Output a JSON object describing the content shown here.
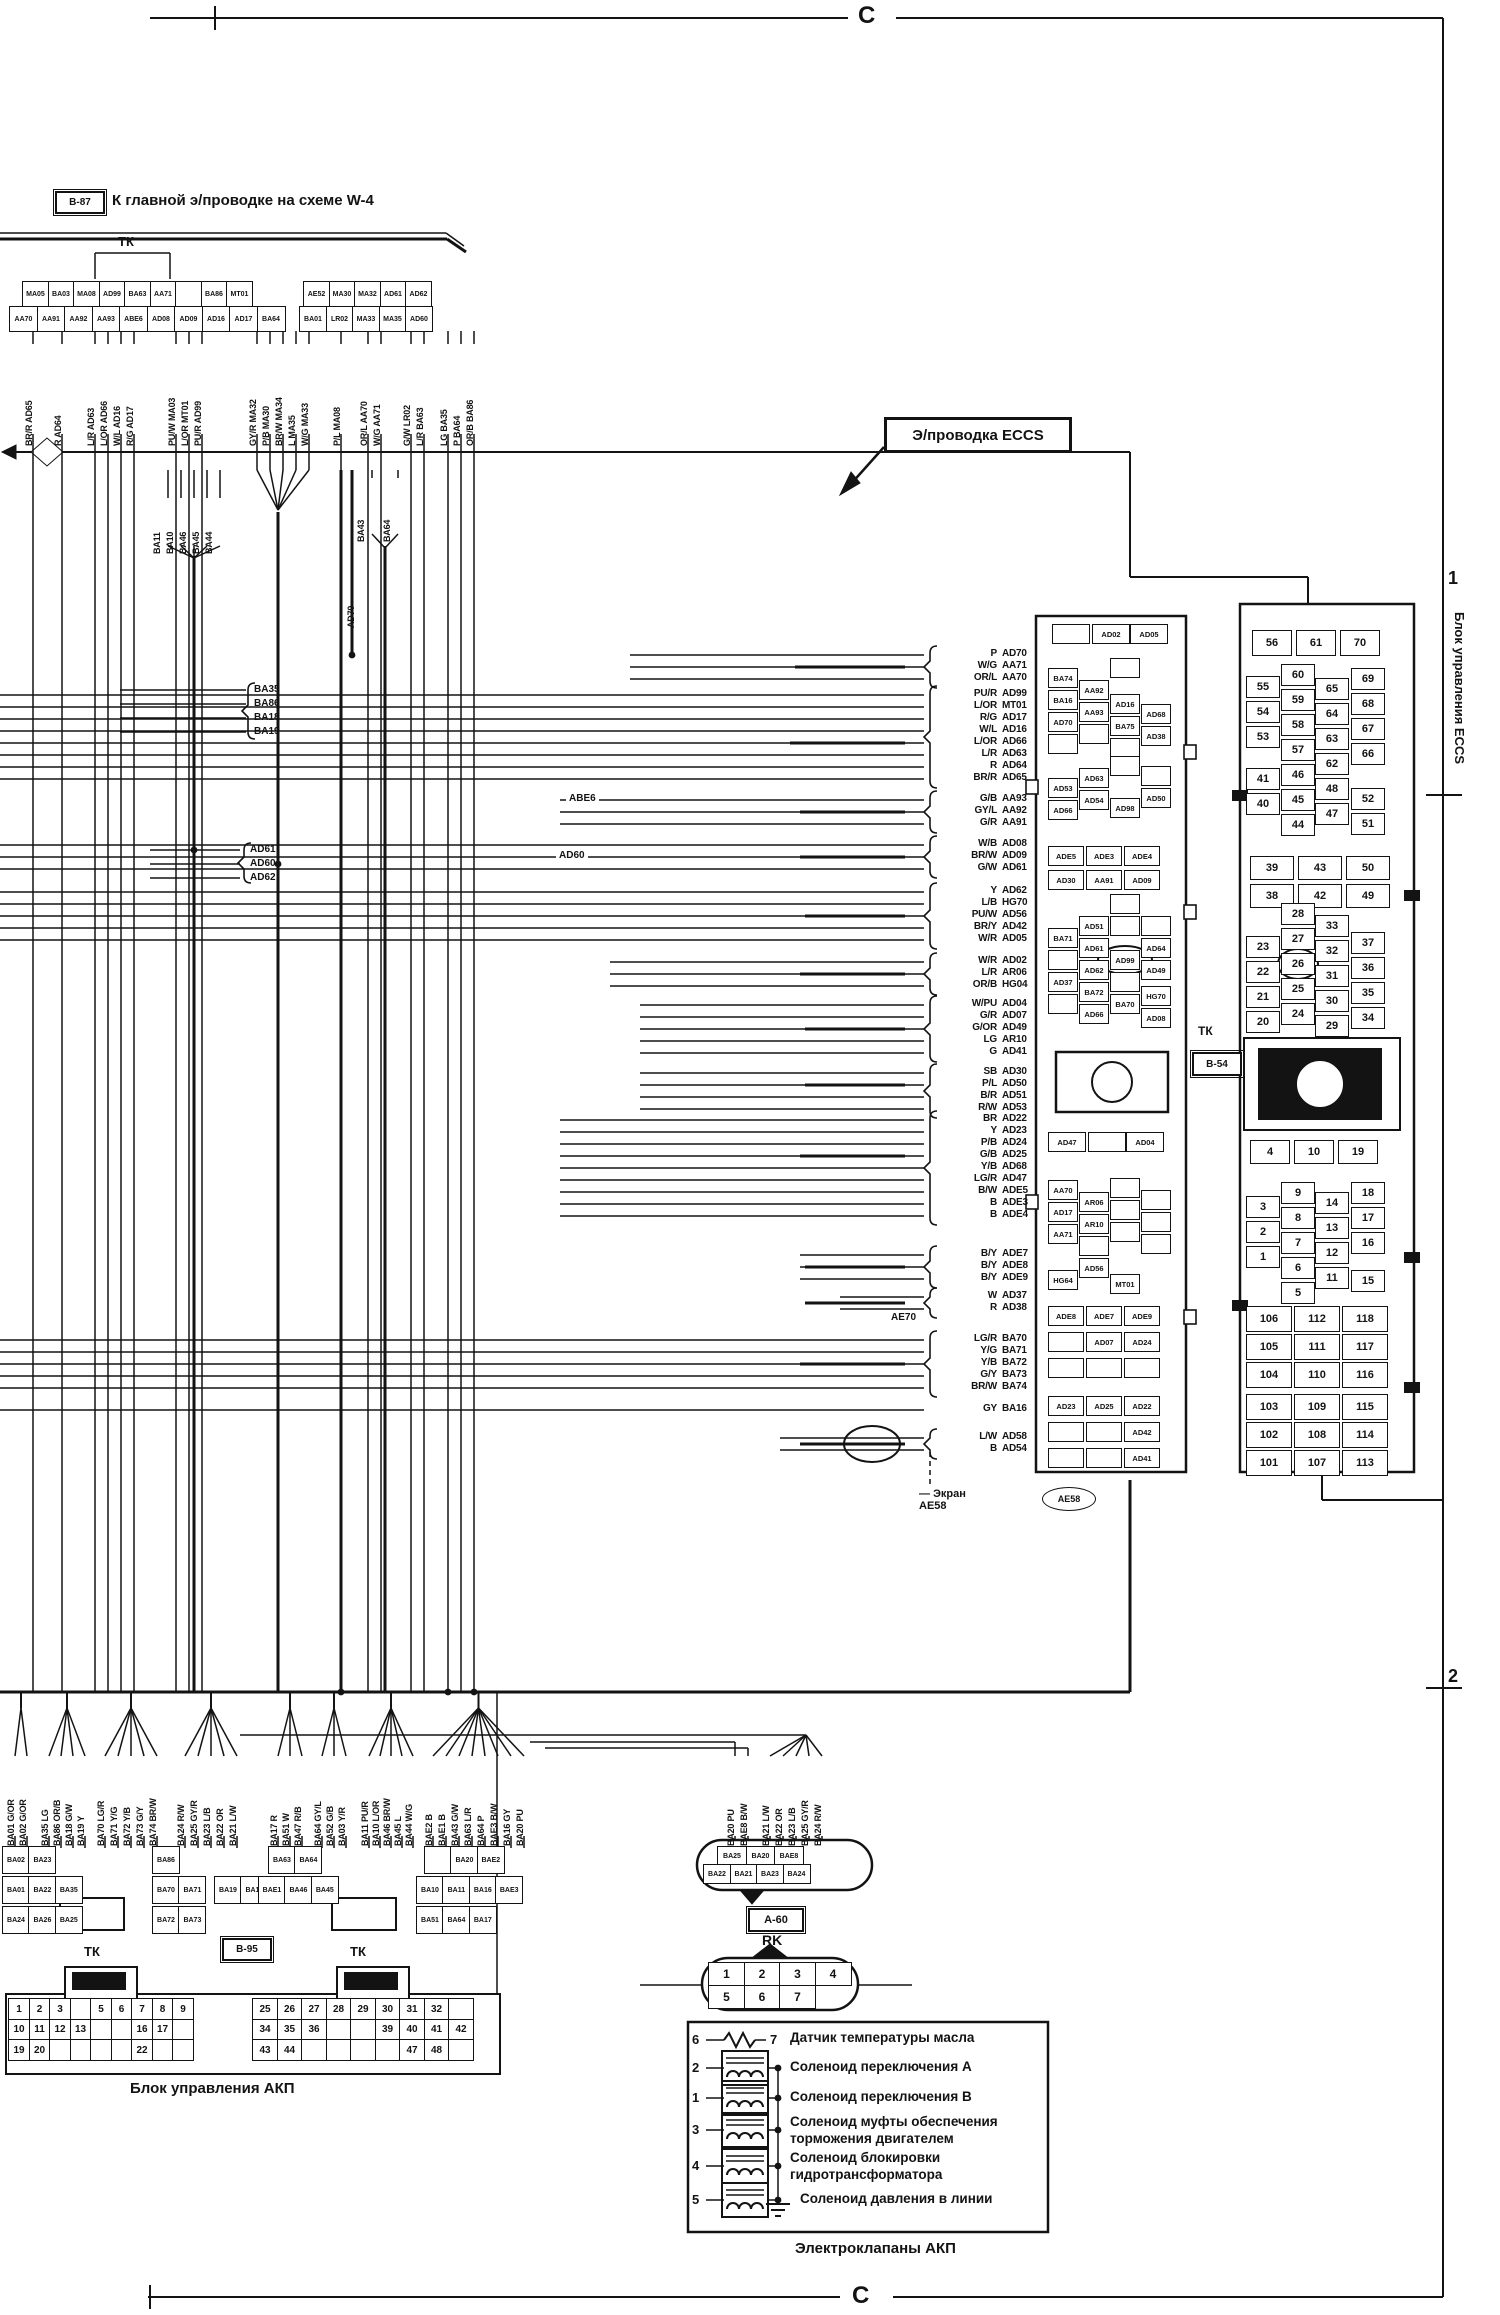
{
  "page": {
    "top_marker": "C",
    "bottom_marker": "C",
    "side_marker_1": "1",
    "side_marker_2": "2"
  },
  "header": {
    "ref": "B-87",
    "title": "К главной э/проводке  на схеме W-4",
    "tk": "ТК"
  },
  "eccs_note": "Э/проводка ECCS",
  "top_connector": {
    "left_row1": [
      "MA05",
      "BA03",
      "MA08",
      "AD99",
      "BA63",
      "AA71",
      "",
      "BA86",
      "MT01"
    ],
    "left_row2": [
      "AA70",
      "AA91",
      "AA92",
      "AA93",
      "ABE6",
      "AD08",
      "AD09",
      "AD16",
      "AD17",
      "BA64"
    ],
    "right_row1": [
      "AE52",
      "MA30",
      "MA32",
      "AD61",
      "AD62"
    ],
    "right_row2": [
      "BA01",
      "LR02",
      "MA33",
      "MA35",
      "AD60"
    ]
  },
  "top_wires": [
    [
      "BR/R",
      "AD65"
    ],
    [
      "R",
      "AD64"
    ],
    [
      "L/R",
      "AD63"
    ],
    [
      "L/OR",
      "AD66"
    ],
    [
      "W/L",
      "AD16"
    ],
    [
      "R/G",
      "AD17"
    ],
    [
      "PU/W",
      "MA03"
    ],
    [
      "L/OR",
      "MT01"
    ],
    [
      "PU/R",
      "AD99"
    ],
    [
      "GY/R",
      "MA32"
    ],
    [
      "P/B",
      "MA30"
    ],
    [
      "BR/W",
      "MA34"
    ],
    [
      "L",
      "MA35"
    ],
    [
      "W/G",
      "MA33"
    ],
    [
      "P/L",
      "MA08"
    ],
    [
      "OR/L",
      "AA70"
    ],
    [
      "W/G",
      "AA71"
    ],
    [
      "G/W",
      "LR02"
    ],
    [
      "L/R",
      "BA63"
    ],
    [
      "LG",
      "BA35"
    ],
    [
      "P",
      "BA64"
    ],
    [
      "OR/B",
      "BA86"
    ]
  ],
  "mid": {
    "group_ba1": [
      "BA11",
      "BA10",
      "BA46",
      "BA45",
      "BA44"
    ],
    "label_ba43": "BA43",
    "label_ba64": "BA64",
    "label_ad70": "AD70",
    "group_ba35": [
      "BA35",
      "BA86",
      "BA18",
      "BA19"
    ],
    "group_ad6": [
      "AD61",
      "AD60",
      "AD62"
    ],
    "label_abe6": "ABE6",
    "label_ad60": "AD60",
    "label_ae70": "AE70"
  },
  "wire_groups": [
    {
      "items": [
        [
          "P",
          "AD70"
        ],
        [
          "W/G",
          "AA71"
        ],
        [
          "OR/L",
          "AA70"
        ]
      ]
    },
    {
      "items": [
        [
          "PU/R",
          "AD99"
        ],
        [
          "L/OR",
          "MT01"
        ],
        [
          "R/G",
          "AD17"
        ],
        [
          "W/L",
          "AD16"
        ],
        [
          "L/OR",
          "AD66"
        ],
        [
          "L/R",
          "AD63"
        ],
        [
          "R",
          "AD64"
        ],
        [
          "BR/R",
          "AD65"
        ]
      ]
    },
    {
      "items": [
        [
          "G/B",
          "AA93"
        ],
        [
          "GY/L",
          "AA92"
        ],
        [
          "G/R",
          "AA91"
        ]
      ]
    },
    {
      "items": [
        [
          "W/B",
          "AD08"
        ],
        [
          "BR/W",
          "AD09"
        ],
        [
          "G/W",
          "AD61"
        ]
      ]
    },
    {
      "items": [
        [
          "Y",
          "AD62"
        ],
        [
          "L/B",
          "HG70"
        ],
        [
          "PU/W",
          "AD56"
        ],
        [
          "BR/Y",
          "AD42"
        ],
        [
          "W/R",
          "AD05"
        ]
      ]
    },
    {
      "items": [
        [
          "W/R",
          "AD02"
        ],
        [
          "L/R",
          "AR06"
        ],
        [
          "OR/B",
          "HG04"
        ]
      ]
    },
    {
      "items": [
        [
          "W/PU",
          "AD04"
        ],
        [
          "G/R",
          "AD07"
        ],
        [
          "G/OR",
          "AD49"
        ],
        [
          "LG",
          "AR10"
        ],
        [
          "G",
          "AD41"
        ]
      ]
    },
    {
      "items": [
        [
          "SB",
          "AD30"
        ],
        [
          "P/L",
          "AD50"
        ],
        [
          "B/R",
          "AD51"
        ],
        [
          "R/W",
          "AD53"
        ]
      ]
    },
    {
      "items": [
        [
          "BR",
          "AD22"
        ],
        [
          "Y",
          "AD23"
        ],
        [
          "P/B",
          "AD24"
        ],
        [
          "G/B",
          "AD25"
        ],
        [
          "Y/B",
          "AD68"
        ],
        [
          "LG/R",
          "AD47"
        ],
        [
          "B/W",
          "ADE5"
        ],
        [
          "B",
          "ADE3"
        ],
        [
          "B",
          "ADE4"
        ]
      ]
    },
    {
      "items": [
        [
          "B/Y",
          "ADE7"
        ],
        [
          "B/Y",
          "ADE8"
        ],
        [
          "B/Y",
          "ADE9"
        ]
      ]
    },
    {
      "items": [
        [
          "W",
          "AD37"
        ],
        [
          "R",
          "AD38"
        ]
      ]
    },
    {
      "items": [
        [
          "LG/R",
          "BA70"
        ],
        [
          "Y/G",
          "BA71"
        ],
        [
          "Y/B",
          "BA72"
        ],
        [
          "G/Y",
          "BA73"
        ],
        [
          "BR/W",
          "BA74"
        ]
      ]
    },
    {
      "items": [
        [
          "GY",
          "BA16"
        ]
      ]
    },
    {
      "items": [
        [
          "L/W",
          "AD58"
        ],
        [
          "B",
          "AD54"
        ]
      ]
    }
  ],
  "screen": {
    "dash": "—",
    "label": "Экран",
    "code": "AE58",
    "oval_code": "AE58"
  },
  "ecu_mid": {
    "circled": "AD99",
    "cells": [
      "",
      "AD02",
      "AD05",
      "BA74",
      "BA16",
      "AD70",
      "",
      "AA92",
      "AA93",
      "",
      "",
      "AD16",
      "BA75",
      "",
      "AD68",
      "AD38",
      "AD53",
      "AD66",
      "AD63",
      "AD54",
      "",
      "AD98",
      "AD50",
      "",
      "ADE5",
      "ADE3",
      "ADE4",
      "AD30",
      "AA91",
      "AD09",
      "BA71",
      "",
      "AD37",
      "",
      "AD51",
      "AD61",
      "AD62",
      "BA72",
      "AD66",
      "",
      "",
      "AD99",
      "",
      "BA70",
      "AD64",
      "AD49",
      "HG70",
      "AD08",
      "",
      "AD47",
      "",
      "AD04",
      "AA70",
      "AD17",
      "AA71",
      "HG64",
      "AR06",
      "AR10",
      "",
      "AD56",
      "",
      "",
      "",
      "MT01",
      "",
      "",
      "",
      "ADE8",
      "ADE7",
      "ADE9",
      "",
      "AD07",
      "AD24",
      "",
      "",
      "",
      "AD23",
      "AD25",
      "AD22",
      "",
      "",
      "AD42",
      "",
      "",
      "AD41"
    ]
  },
  "eccs": {
    "tk": "ТК",
    "ref": "B-54",
    "side_label": "Блок управления ECCS",
    "top_row": [
      "56",
      "61",
      "70"
    ],
    "g1": [
      [
        "55",
        "54",
        "53"
      ],
      [
        "60",
        "59",
        "58",
        "57",
        "46",
        "45",
        "44"
      ],
      [
        "65",
        "64",
        "63",
        "62",
        "48",
        "47"
      ],
      [
        "69",
        "68",
        "67",
        "66"
      ]
    ],
    "g1_extra0": [
      "41",
      "40"
    ],
    "g1_extra3": [
      "52",
      "51"
    ],
    "mid_rows": [
      [
        "39",
        "43",
        "50"
      ],
      [
        "38",
        "42",
        "49"
      ]
    ],
    "g2": [
      [
        "23",
        "22",
        "21",
        "20"
      ],
      [
        "28",
        "27",
        "26",
        "25",
        "24"
      ],
      [
        "33",
        "32",
        "31",
        "30",
        "29"
      ],
      [
        "37",
        "36",
        "35",
        "34"
      ]
    ],
    "circled": "26",
    "row4": [
      "4",
      "10",
      "19"
    ],
    "g3": [
      [
        "3",
        "2",
        "1"
      ],
      [
        "9",
        "8",
        "7",
        "6",
        "5"
      ],
      [
        "14",
        "13",
        "12",
        "11"
      ],
      [
        "18",
        "17",
        "16"
      ]
    ],
    "g3_extra": "15",
    "g4": [
      [
        "106",
        "112",
        "118"
      ],
      [
        "105",
        "111",
        "117"
      ],
      [
        "104",
        "110",
        "116"
      ]
    ],
    "g5": [
      [
        "103",
        "109",
        "115"
      ],
      [
        "102",
        "108",
        "114"
      ],
      [
        "101",
        "107",
        "113"
      ]
    ]
  },
  "bottom_wires": [
    {
      "items": [
        [
          "G/OR",
          "BA01"
        ],
        [
          "G/OR",
          "BA02"
        ]
      ]
    },
    {
      "items": [
        [
          "LG",
          "BA35"
        ],
        [
          "OR/B",
          "BA86"
        ],
        [
          "G/W",
          "BA18"
        ],
        [
          "Y",
          "BA19"
        ]
      ]
    },
    {
      "items": [
        [
          "LG/R",
          "BA70"
        ],
        [
          "Y/G",
          "BA71"
        ],
        [
          "Y/B",
          "BA72"
        ],
        [
          "G/Y",
          "BA73"
        ],
        [
          "BR/W",
          "BA74"
        ]
      ]
    },
    {
      "items": [
        [
          "R/W",
          "BA24"
        ],
        [
          "GY/R",
          "BA25"
        ],
        [
          "L/B",
          "BA23"
        ],
        [
          "OR",
          "BA22"
        ],
        [
          "L/W",
          "BA21"
        ]
      ]
    },
    {
      "items": [
        [
          "R",
          "BA17"
        ],
        [
          "W",
          "BA51"
        ],
        [
          "R/B",
          "BA47"
        ]
      ]
    },
    {
      "items": [
        [
          "GY/L",
          "BA64"
        ],
        [
          "G/B",
          "BA52"
        ],
        [
          "Y/R",
          "BA03"
        ]
      ]
    },
    {
      "items": [
        [
          "PU/R",
          "BA11"
        ],
        [
          "L/OR",
          "BA10"
        ],
        [
          "BR/W",
          "BA46"
        ],
        [
          "L",
          "BA45"
        ],
        [
          "W/G",
          "BA44"
        ]
      ]
    },
    {
      "items": [
        [
          "B",
          "BAE2"
        ],
        [
          "B",
          "BAE1"
        ],
        [
          "G/W",
          "BA43"
        ],
        [
          "L/R",
          "BA63"
        ],
        [
          "P",
          "BA64"
        ],
        [
          "B/W",
          "BAE3"
        ],
        [
          "GY",
          "BA16"
        ],
        [
          "PU",
          "BA20"
        ]
      ]
    },
    {
      "items": [
        [
          "PU",
          "BA20"
        ],
        [
          "B/W",
          "BAE8"
        ]
      ]
    },
    {
      "items": [
        [
          "L/W",
          "BA21"
        ],
        [
          "OR",
          "BA22"
        ],
        [
          "L/B",
          "BA23"
        ],
        [
          "GY/R",
          "BA25"
        ],
        [
          "R/W",
          "BA24"
        ]
      ]
    }
  ],
  "bottom_connectors": [
    {
      "rows": [
        [
          "BA02",
          "BA23"
        ]
      ]
    },
    {
      "rows": [
        [
          "BA01",
          "BA22",
          "BA35"
        ]
      ]
    },
    {
      "rows": [
        [
          "BA24",
          "BA26",
          "BA25"
        ]
      ]
    },
    {
      "rows": [
        [
          "BA86"
        ]
      ]
    },
    {
      "rows": [
        [
          "BA70",
          "BA71"
        ]
      ]
    },
    {
      "rows": [
        [
          "BA72",
          "BA73"
        ]
      ]
    },
    {
      "rows": [
        [
          "BA19",
          "BA18"
        ]
      ]
    },
    {
      "rows": [
        [
          "BA63",
          "BA64"
        ]
      ]
    },
    {
      "rows": [
        [
          "BAE1",
          "BA46",
          "BA45"
        ]
      ]
    },
    {
      "rows": [
        [
          "",
          "BA20",
          "BAE2"
        ]
      ]
    },
    {
      "rows": [
        [
          "BA10",
          "BA11",
          "BA16",
          "BAE3"
        ]
      ]
    },
    {
      "rows": [
        [
          "BA51",
          "BA64",
          "BA17"
        ]
      ]
    }
  ],
  "akp": {
    "label": "Блок управления АКП",
    "tk_left": "ТК",
    "ref": "B-95",
    "tk_right": "ТК",
    "left": [
      [
        "1",
        "2",
        "3",
        "",
        "5",
        "6",
        "7",
        "8",
        "9"
      ],
      [
        "10",
        "11",
        "12",
        "13",
        "",
        "",
        "16",
        "17",
        ""
      ],
      [
        "19",
        "20",
        "",
        "",
        "",
        "",
        "22",
        "",
        ""
      ]
    ],
    "right": [
      [
        "25",
        "26",
        "27",
        "28",
        "29",
        "30",
        "31",
        "32",
        ""
      ],
      [
        "34",
        "35",
        "36",
        "",
        "",
        "39",
        "40",
        "41",
        "42"
      ],
      [
        "43",
        "44",
        "",
        "",
        "",
        "",
        "47",
        "48",
        ""
      ]
    ]
  },
  "rk": {
    "ref": "A-60",
    "label": "RK",
    "top_row": [
      "BA25",
      "BA20",
      "BAE8"
    ],
    "bottom_row": [
      "BA22",
      "BA21",
      "BA23",
      "BA24"
    ],
    "pins1": [
      "1",
      "2",
      "3",
      "4"
    ],
    "pins2": [
      "5",
      "6",
      "7"
    ]
  },
  "solenoids": {
    "title": "Электроклапаны АКП",
    "rows": [
      {
        "pin": "6",
        "pin2": "7",
        "text": "Датчик температуры масла",
        "type": "resistor"
      },
      {
        "pin": "2",
        "text": "Соленоид переключения А",
        "type": "coil"
      },
      {
        "pin": "1",
        "text": "Соленоид переключения В",
        "type": "coil"
      },
      {
        "pin": "3",
        "text": "Соленоид муфты обеспечения\nторможения двигателем",
        "type": "coil"
      },
      {
        "pin": "4",
        "text": "Соленоид блокировки\nгидротрансформатора",
        "type": "coil"
      },
      {
        "pin": "5",
        "text": "Соленоид давления в линии",
        "type": "coil",
        "ground": true
      }
    ]
  }
}
